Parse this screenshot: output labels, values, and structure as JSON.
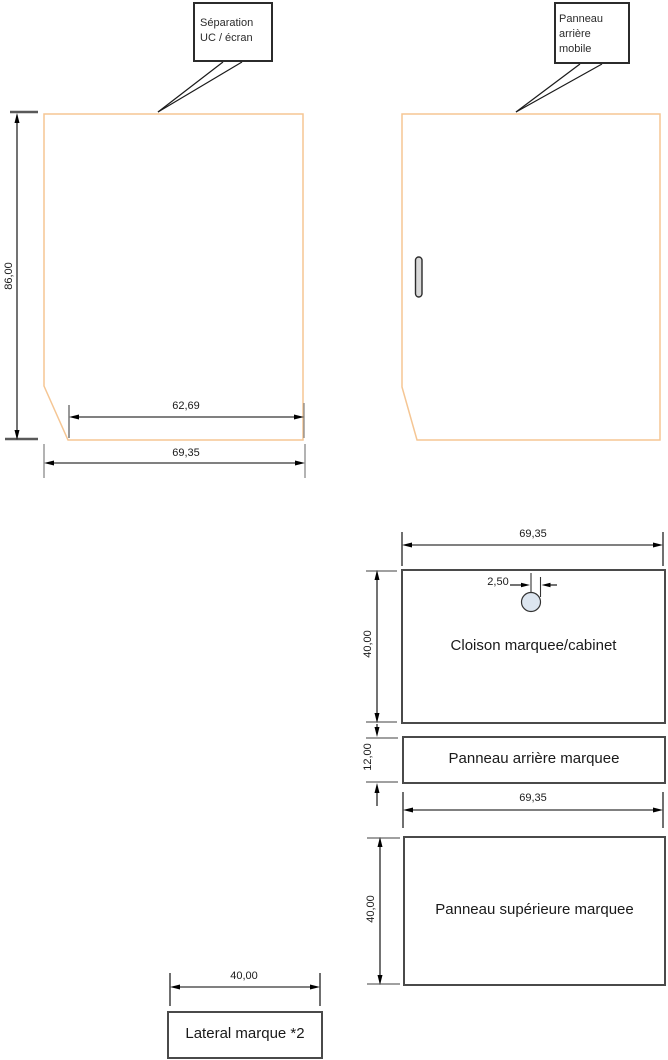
{
  "drawing": {
    "separation_panel": {
      "callout": "Séparation\nUC / écran",
      "height_dim": "86,00",
      "bottom_width_dim": "62,69",
      "total_width_dim": "69,35"
    },
    "mobile_panel": {
      "callout": "Panneau\narrière\nmobile"
    },
    "cloison": {
      "label": "Cloison marquee/cabinet",
      "width_dim": "69,35",
      "height_dim": "40,00",
      "hole_dim": "2,50"
    },
    "panneau_arriere": {
      "label": "Panneau arrière marquee",
      "height_dim": "12,00",
      "width_dim": "69,35"
    },
    "panneau_superieure": {
      "label": "Panneau supérieure marquee",
      "height_dim": "40,00"
    },
    "lateral": {
      "label": "Lateral marque *2",
      "width_dim": "40,00"
    },
    "colors": {
      "panel_outline": "#f5c694",
      "part_outline": "#4a4a4a",
      "dimension_line": "#000000",
      "extension_dark": "#595959",
      "extension_gray": "#808080",
      "hole_fill": "#dde6f0",
      "handle_fill": "#d9d9d9"
    }
  }
}
